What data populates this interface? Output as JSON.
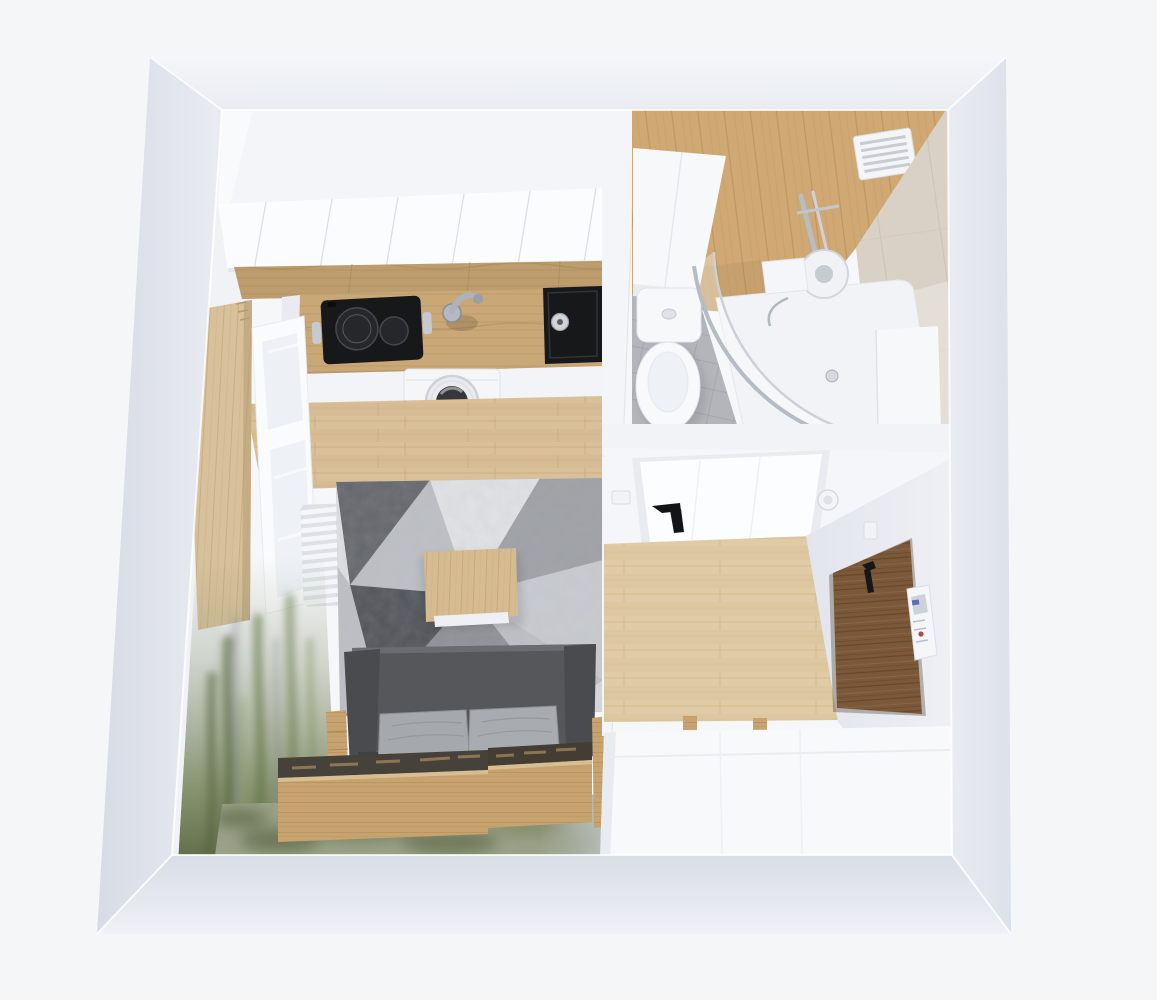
{
  "scene": {
    "type": "3d-floorplan-render",
    "description": "Top-down 3D architectural render of a small studio apartment with kitchen-living room, bathroom and entrance hall",
    "rooms": [
      {
        "name": "kitchen-living-room",
        "items": [
          "upper-cabinets",
          "wood-backsplash",
          "wood-countertop",
          "induction-cooktop",
          "kitchen-faucet",
          "black-sink",
          "washing-machine",
          "base-cabinets",
          "wood-floor",
          "tall-wood-panel",
          "window",
          "ladder-radiator",
          "forest-wall-mural",
          "geometric-gray-rug",
          "wood-coffee-table",
          "gray-sofa",
          "seat-pillows",
          "wood-storage-drawer-left",
          "wood-storage-drawer-right",
          "wood-side-unit",
          "green-moss-rug"
        ]
      },
      {
        "name": "bathroom",
        "items": [
          "wood-plank-wall",
          "vent-grille",
          "white-vanity",
          "toilet",
          "quarter-round-shower-enclosure",
          "shower-tray",
          "chrome-shower-set",
          "shower-shelf",
          "beige-tile-wall",
          "gray-tile-floor",
          "white-cabinet"
        ]
      },
      {
        "name": "hallway",
        "items": [
          "bathroom-door",
          "black-door-handle",
          "smoke-detector",
          "light-switch",
          "wood-floor",
          "walnut-entrance-door",
          "entrance-door-handle",
          "intercom-panel",
          "entrance-light-switch",
          "built-in-wardrobe",
          "wardrobe-wood-hinges"
        ]
      }
    ],
    "palette": {
      "bg": "#f5f6f8",
      "wall_face": "#dbdfe8",
      "wall_top": "#f0f2f6",
      "wall_front": "#e7eaf1",
      "interior_white": "#f6f7f9",
      "wood_floor": "#d9c099",
      "wood_hall": "#e0cba6",
      "wood_counter": "#c9a777",
      "wood_bath_wall": "#cfa873",
      "wood_box": "#c7a370",
      "walnut_door": "#7b583a",
      "tile_beige": "#d9d1c6",
      "tile_gray": "#b3b5ba",
      "rug_base": "#bdc0c5",
      "rug_dark": "#515459",
      "rug_light": "#e2e3e6",
      "sofa_dark": "#55575b",
      "pillow_gray": "#a5a8ad",
      "moss_green": "#5f6c47",
      "rug_green": "#9aa188",
      "appliance_black": "#17181a",
      "chrome": "#c6cad0",
      "white_fixture": "#f7f8fa"
    }
  }
}
